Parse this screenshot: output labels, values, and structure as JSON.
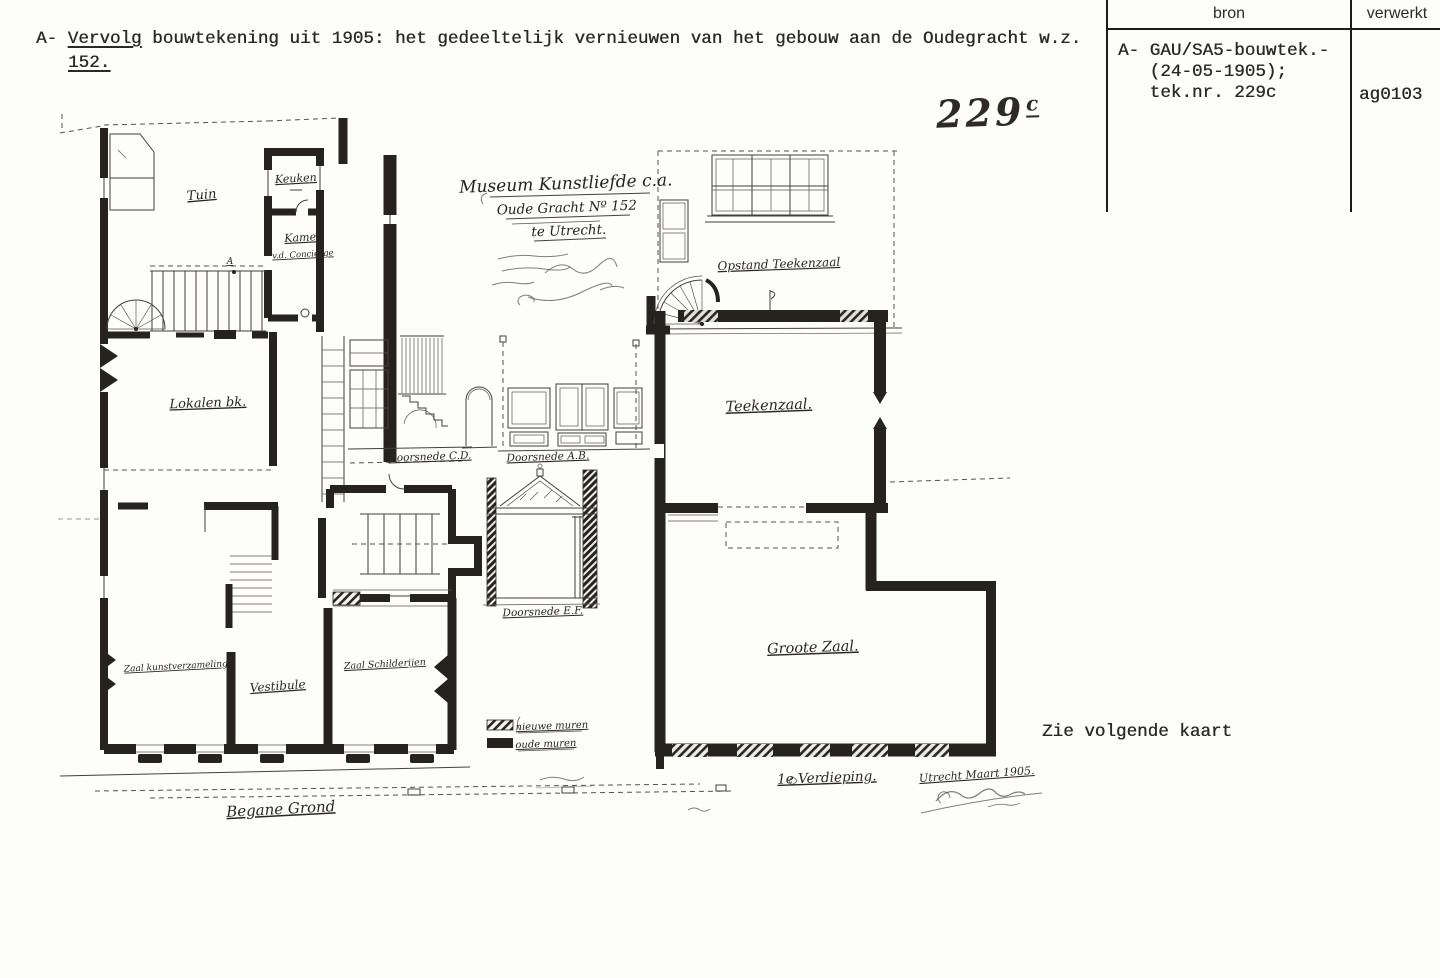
{
  "page": {
    "paper": "#fdfdfa",
    "ink": "#2b2925",
    "table_line": "#1c1c1c"
  },
  "header": {
    "prefix": "A-",
    "underlined_word": "Vervolg",
    "line1_rest": " bouwtekening uit 1905: het gedeeltelijk vernieuwen van het gebouw aan de Oudegracht w.z.",
    "line2": "152."
  },
  "ref_table": {
    "col_bron": "bron",
    "col_verwerkt": "verwerkt",
    "bron_lines": [
      "A- GAU/SA5-bouwtek.-",
      "(24-05-1905);",
      "tek.nr. 229c"
    ],
    "verwerkt_value": "ag0103"
  },
  "drawing_number": {
    "digits": "229",
    "suffix": "c"
  },
  "note_bottom_right": "Zie volgende kaart",
  "plan": {
    "title_block": {
      "line1": "Museum Kunstliefde c.a.",
      "line2": "Oude Gracht Nº 152",
      "line3": "te Utrecht."
    },
    "labels": {
      "tuin": "Tuin",
      "keuken": "Keuken",
      "kamer": "Kamer",
      "kamer_sub": "v.d. Concierge",
      "lokalen": "Lokalen bk.",
      "marker_a": "A",
      "zaal_kunst": "Zaal kunstverzameling",
      "vestibule": "Vestibule",
      "zaal_schilderijen": "Zaal Schilderijen",
      "begane_grond": "Begane Grond",
      "doorsnede_cd": "Doorsnede C.D.",
      "doorsnede_ab": "Doorsnede A.B.",
      "doorsnede_ef": "Doorsnede E.F.",
      "opstand": "Opstand Teekenzaal",
      "teekenzaal": "Teekenzaal.",
      "groote_zaal": "Groote Zaal.",
      "verdieping": "1e Verdieping.",
      "date_signature": "Utrecht Maart 1905."
    },
    "legend": {
      "new_walls": "nieuwe muren",
      "old_walls": "oude muren"
    }
  }
}
